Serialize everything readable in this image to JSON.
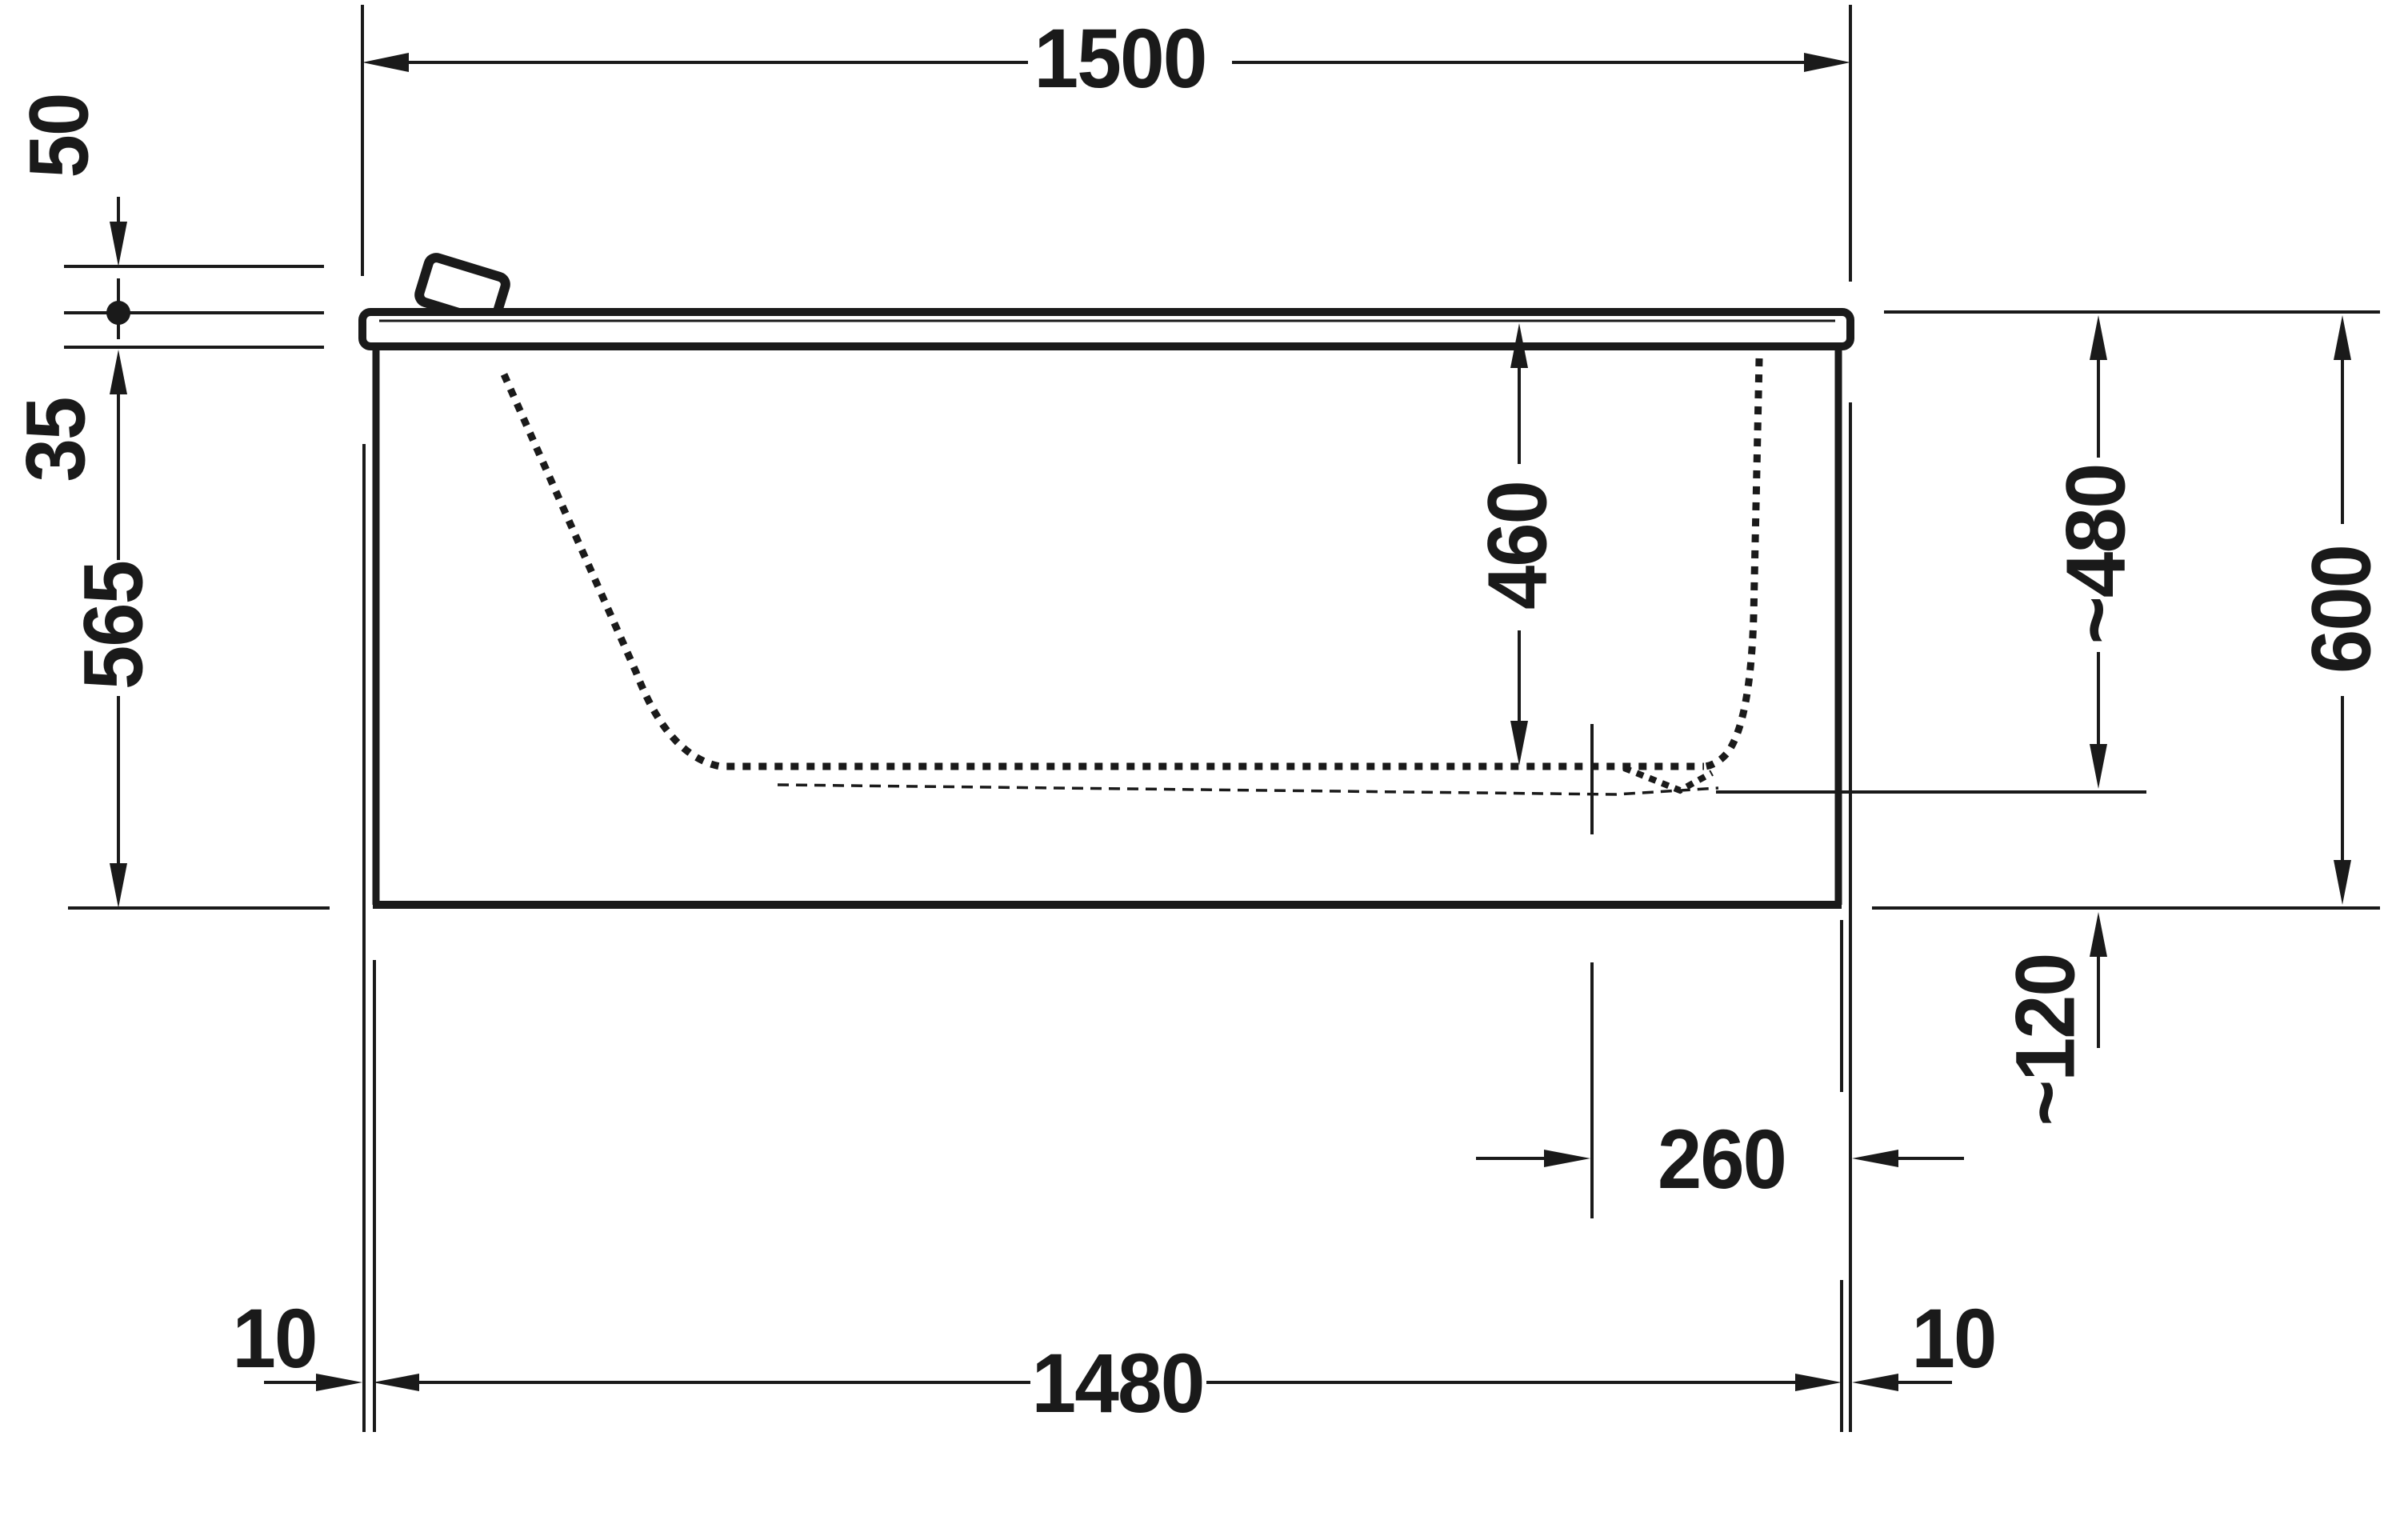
{
  "drawing": {
    "kind": "bathtub-side-elevation-technical-drawing",
    "units": "mm",
    "colors": {
      "ink": "#1a1a1a",
      "background": "#ffffff"
    },
    "dimensions": {
      "overall_length": {
        "label": "1500"
      },
      "rim_top_offset": {
        "label": "50"
      },
      "rim_thickness": {
        "label": "35"
      },
      "below_rim_height": {
        "label": "565"
      },
      "inner_depth": {
        "label": "460"
      },
      "approx_water_level": {
        "label": "~480"
      },
      "overall_height": {
        "label": "600"
      },
      "approx_outlet_height": {
        "label": "~120"
      },
      "drain_to_end": {
        "label": "260"
      },
      "body_length": {
        "label": "1480"
      },
      "overhang_left": {
        "label": "10"
      },
      "overhang_right": {
        "label": "10"
      }
    }
  }
}
